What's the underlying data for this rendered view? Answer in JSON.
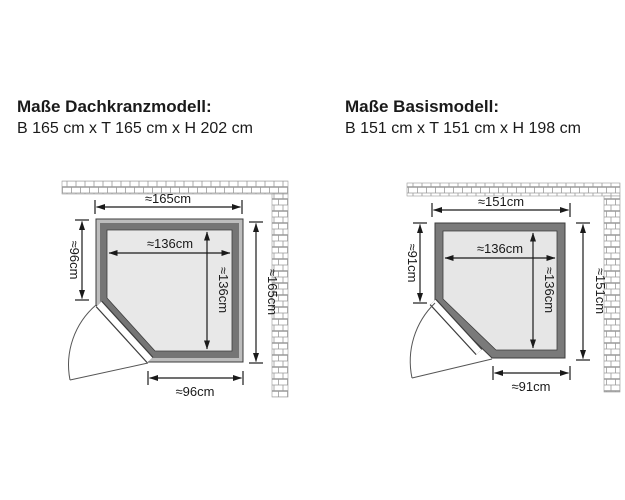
{
  "models": [
    {
      "title": "Maße Dachkranzmodell:",
      "dimensions_line": "B 165 cm x T 165 cm x H 202 cm",
      "labels": {
        "width_top": "≈165cm",
        "left_depth": "≈96cm",
        "inner_width": "≈136cm",
        "inner_depth": "≈136cm",
        "right_depth": "≈165cm",
        "bottom_width": "≈96cm"
      }
    },
    {
      "title": "Maße Basismodell:",
      "dimensions_line": "B 151 cm x T 151 cm x H 198 cm",
      "labels": {
        "width_top": "≈151cm",
        "left_depth": "≈91cm",
        "inner_width": "≈136cm",
        "inner_depth": "≈136cm",
        "right_depth": "≈151cm",
        "bottom_width": "≈91cm"
      }
    }
  ],
  "colors": {
    "wall_outer_band": "#bdbdbd",
    "wall_frame_dark": "#757575",
    "interior": "#e8e8e8",
    "outline": "#3c3c3c",
    "dimension_line": "#1a1a1a",
    "brick_mortar": "#9a9a9a"
  }
}
